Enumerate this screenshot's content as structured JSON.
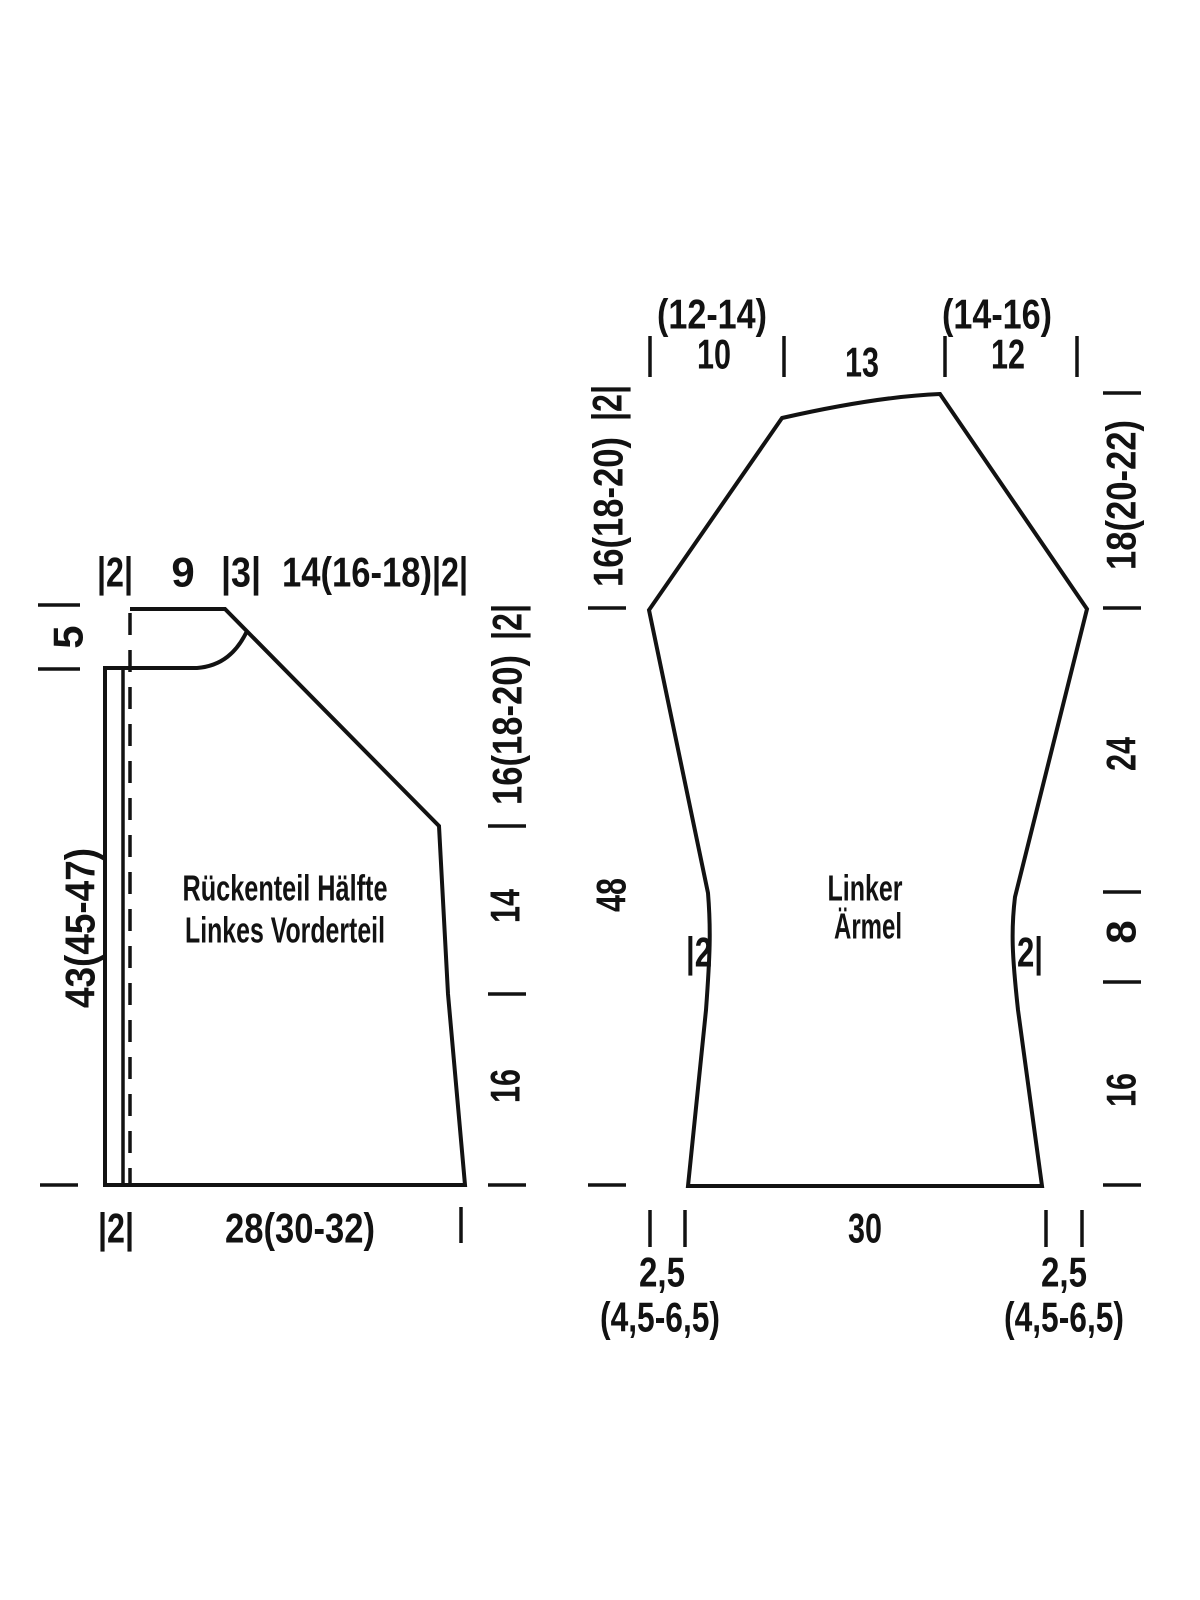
{
  "canvas": {
    "width": 1200,
    "height": 1600,
    "background": "#ffffff",
    "ink": "#121212"
  },
  "pieces": [
    {
      "name": "back-and-front-piece",
      "paths": [
        {
          "name": "back-front-outline",
          "d": "M130,609 L225,609 L439,826 L448,994 L465,1185 L105,1185 L105,668 L197,668 C222,666 237,652 247,631",
          "dashed": false,
          "width": 4
        },
        {
          "name": "front-band-line",
          "d": "M123,668 L123,1185",
          "dashed": false,
          "width": 3.5
        },
        {
          "name": "center-fold-dashed-line",
          "d": "M130,613 L130,1185",
          "dashed": true,
          "width": 3.5
        }
      ],
      "ticks": [
        {
          "name": "tick-collar-top-left",
          "x1": 38,
          "y1": 605,
          "x2": 80,
          "y2": 605
        },
        {
          "name": "tick-neck-left",
          "x1": 38,
          "y1": 669,
          "x2": 80,
          "y2": 669
        },
        {
          "name": "tick-hem-left",
          "x1": 40,
          "y1": 1185,
          "x2": 78,
          "y2": 1185
        },
        {
          "name": "tick-armhole-right",
          "x1": 488,
          "y1": 826,
          "x2": 526,
          "y2": 826
        },
        {
          "name": "tick-waist-right",
          "x1": 488,
          "y1": 994,
          "x2": 526,
          "y2": 994
        },
        {
          "name": "tick-hem-right",
          "x1": 488,
          "y1": 1185,
          "x2": 526,
          "y2": 1185
        },
        {
          "name": "tick-hem-bottom-right",
          "x1": 461,
          "y1": 1207,
          "x2": 461,
          "y2": 1243
        }
      ],
      "labels": [
        {
          "name": "measure-top-band",
          "t": "|2|",
          "x": 115,
          "y": 572,
          "rot": false,
          "s": 42,
          "w": 36
        },
        {
          "name": "measure-top-9",
          "t": "9",
          "x": 183,
          "y": 572,
          "rot": false,
          "s": 42
        },
        {
          "name": "measure-top-3",
          "t": "|3|",
          "x": 241,
          "y": 572,
          "rot": false,
          "s": 42,
          "w": 40
        },
        {
          "name": "measure-top-shoulder",
          "t": "14(16-18)",
          "x": 357,
          "y": 572,
          "rot": false,
          "s": 42,
          "w": 150
        },
        {
          "name": "measure-top-2",
          "t": "|2|",
          "x": 450,
          "y": 572,
          "rot": false,
          "s": 42,
          "w": 36
        },
        {
          "name": "measure-collar-5",
          "t": "5",
          "x": 68,
          "y": 637,
          "rot": true,
          "s": 42
        },
        {
          "name": "measure-length-43",
          "t": "43(45-47)",
          "x": 80,
          "y": 928,
          "rot": true,
          "s": 42,
          "w": 160
        },
        {
          "name": "measure-right-2",
          "t": "|2|",
          "x": 507,
          "y": 622,
          "rot": true,
          "s": 42,
          "w": 36
        },
        {
          "name": "measure-right-16-18-20",
          "t": "16(18-20)",
          "x": 507,
          "y": 730,
          "rot": true,
          "s": 42,
          "w": 150
        },
        {
          "name": "measure-right-14",
          "t": "14",
          "x": 505,
          "y": 906,
          "rot": true,
          "s": 42,
          "w": 34
        },
        {
          "name": "measure-right-16",
          "t": "16",
          "x": 505,
          "y": 1086,
          "rot": true,
          "s": 42,
          "w": 34
        },
        {
          "name": "measure-bottom-band",
          "t": "|2|",
          "x": 116,
          "y": 1228,
          "rot": false,
          "s": 42,
          "w": 36
        },
        {
          "name": "measure-bottom-width",
          "t": "28(30-32)",
          "x": 300,
          "y": 1228,
          "rot": false,
          "s": 42,
          "w": 150
        },
        {
          "name": "piece-title-line1",
          "t": "Rückenteil Hälfte",
          "x": 285,
          "y": 888,
          "rot": false,
          "s": 36,
          "w": 205
        },
        {
          "name": "piece-title-line2",
          "t": "Linkes Vorderteil",
          "x": 285,
          "y": 930,
          "rot": false,
          "s": 36,
          "w": 200
        }
      ]
    },
    {
      "name": "sleeve-piece",
      "paths": [
        {
          "name": "sleeve-outline",
          "d": "M688,1186 L1042,1186 L1018,1010 C1012,955 1011,930 1015,897 L1087,609 L940,394 C890,396 835,406 782,418 L649,610 L708,893 C711,930 710,955 706,1010 Z",
          "dashed": false,
          "width": 4
        }
      ],
      "ticks": [
        {
          "name": "tick-cap-top-1",
          "x1": 650,
          "y1": 336,
          "x2": 650,
          "y2": 377
        },
        {
          "name": "tick-cap-top-2",
          "x1": 784,
          "y1": 336,
          "x2": 784,
          "y2": 377
        },
        {
          "name": "tick-cap-top-3",
          "x1": 945,
          "y1": 336,
          "x2": 945,
          "y2": 377
        },
        {
          "name": "tick-cap-top-4",
          "x1": 1077,
          "y1": 336,
          "x2": 1077,
          "y2": 377
        },
        {
          "name": "tick-left-underarm",
          "x1": 588,
          "y1": 608,
          "x2": 626,
          "y2": 608
        },
        {
          "name": "tick-left-cuff",
          "x1": 588,
          "y1": 1185,
          "x2": 626,
          "y2": 1185
        },
        {
          "name": "tick-right-cap-top",
          "x1": 1103,
          "y1": 393,
          "x2": 1141,
          "y2": 393
        },
        {
          "name": "tick-right-underarm",
          "x1": 1103,
          "y1": 608,
          "x2": 1141,
          "y2": 608
        },
        {
          "name": "tick-right-elbow",
          "x1": 1103,
          "y1": 892,
          "x2": 1141,
          "y2": 892
        },
        {
          "name": "tick-right-wrist",
          "x1": 1103,
          "y1": 982,
          "x2": 1141,
          "y2": 982
        },
        {
          "name": "tick-right-cuff",
          "x1": 1103,
          "y1": 1185,
          "x2": 1141,
          "y2": 1185
        },
        {
          "name": "tick-cuff-left-a",
          "x1": 650,
          "y1": 1210,
          "x2": 650,
          "y2": 1247
        },
        {
          "name": "tick-cuff-left-b",
          "x1": 685,
          "y1": 1210,
          "x2": 685,
          "y2": 1247
        },
        {
          "name": "tick-cuff-right-a",
          "x1": 1046,
          "y1": 1210,
          "x2": 1046,
          "y2": 1247
        },
        {
          "name": "tick-cuff-right-b",
          "x1": 1082,
          "y1": 1210,
          "x2": 1082,
          "y2": 1247
        }
      ],
      "labels": [
        {
          "name": "measure-cap-12-14",
          "t": "(12-14)",
          "x": 712,
          "y": 314,
          "rot": false,
          "s": 42,
          "w": 110
        },
        {
          "name": "measure-cap-10",
          "t": "10",
          "x": 714,
          "y": 354,
          "rot": false,
          "s": 42,
          "w": 34
        },
        {
          "name": "measure-cap-13",
          "t": "13",
          "x": 862,
          "y": 362,
          "rot": false,
          "s": 42,
          "w": 34
        },
        {
          "name": "measure-cap-14-16",
          "t": "(14-16)",
          "x": 997,
          "y": 314,
          "rot": false,
          "s": 42,
          "w": 110
        },
        {
          "name": "measure-cap-12",
          "t": "12",
          "x": 1008,
          "y": 354,
          "rot": false,
          "s": 42,
          "w": 34
        },
        {
          "name": "measure-left-2",
          "t": "|2|",
          "x": 607,
          "y": 403,
          "rot": true,
          "s": 42,
          "w": 36
        },
        {
          "name": "measure-left-16-18-20",
          "t": "16(18-20)",
          "x": 608,
          "y": 512,
          "rot": true,
          "s": 42,
          "w": 150
        },
        {
          "name": "measure-left-48",
          "t": "48",
          "x": 611,
          "y": 895,
          "rot": true,
          "s": 42,
          "w": 34
        },
        {
          "name": "measure-right-18-20-22",
          "t": "18(20-22)",
          "x": 1121,
          "y": 495,
          "rot": true,
          "s": 42,
          "w": 150
        },
        {
          "name": "measure-right-24",
          "t": "24",
          "x": 1121,
          "y": 754,
          "rot": true,
          "s": 42,
          "w": 34
        },
        {
          "name": "measure-right-8",
          "t": "8",
          "x": 1121,
          "y": 932,
          "rot": true,
          "s": 42
        },
        {
          "name": "measure-right-16",
          "t": "16",
          "x": 1121,
          "y": 1090,
          "rot": true,
          "s": 42,
          "w": 34
        },
        {
          "name": "measure-waist-left-2",
          "t": "|2",
          "x": 699,
          "y": 952,
          "rot": false,
          "s": 42,
          "w": 26
        },
        {
          "name": "measure-waist-right-2",
          "t": "2|",
          "x": 1030,
          "y": 952,
          "rot": false,
          "s": 42,
          "w": 26
        },
        {
          "name": "measure-cuff-30",
          "t": "30",
          "x": 865,
          "y": 1228,
          "rot": false,
          "s": 42,
          "w": 34
        },
        {
          "name": "measure-cuff-left-25",
          "t": "2,5",
          "x": 662,
          "y": 1272,
          "rot": false,
          "s": 42,
          "w": 46
        },
        {
          "name": "measure-cuff-left-range",
          "t": "(4,5-6,5)",
          "x": 660,
          "y": 1317,
          "rot": false,
          "s": 42,
          "w": 120
        },
        {
          "name": "measure-cuff-right-25",
          "t": "2,5",
          "x": 1064,
          "y": 1272,
          "rot": false,
          "s": 42,
          "w": 46
        },
        {
          "name": "measure-cuff-right-range",
          "t": "(4,5-6,5)",
          "x": 1064,
          "y": 1317,
          "rot": false,
          "s": 42,
          "w": 120
        },
        {
          "name": "piece-title-line1",
          "t": "Linker",
          "x": 865,
          "y": 888,
          "rot": false,
          "s": 36,
          "w": 75
        },
        {
          "name": "piece-title-line2",
          "t": "Ärmel",
          "x": 868,
          "y": 926,
          "rot": false,
          "s": 36,
          "w": 68
        }
      ]
    }
  ]
}
